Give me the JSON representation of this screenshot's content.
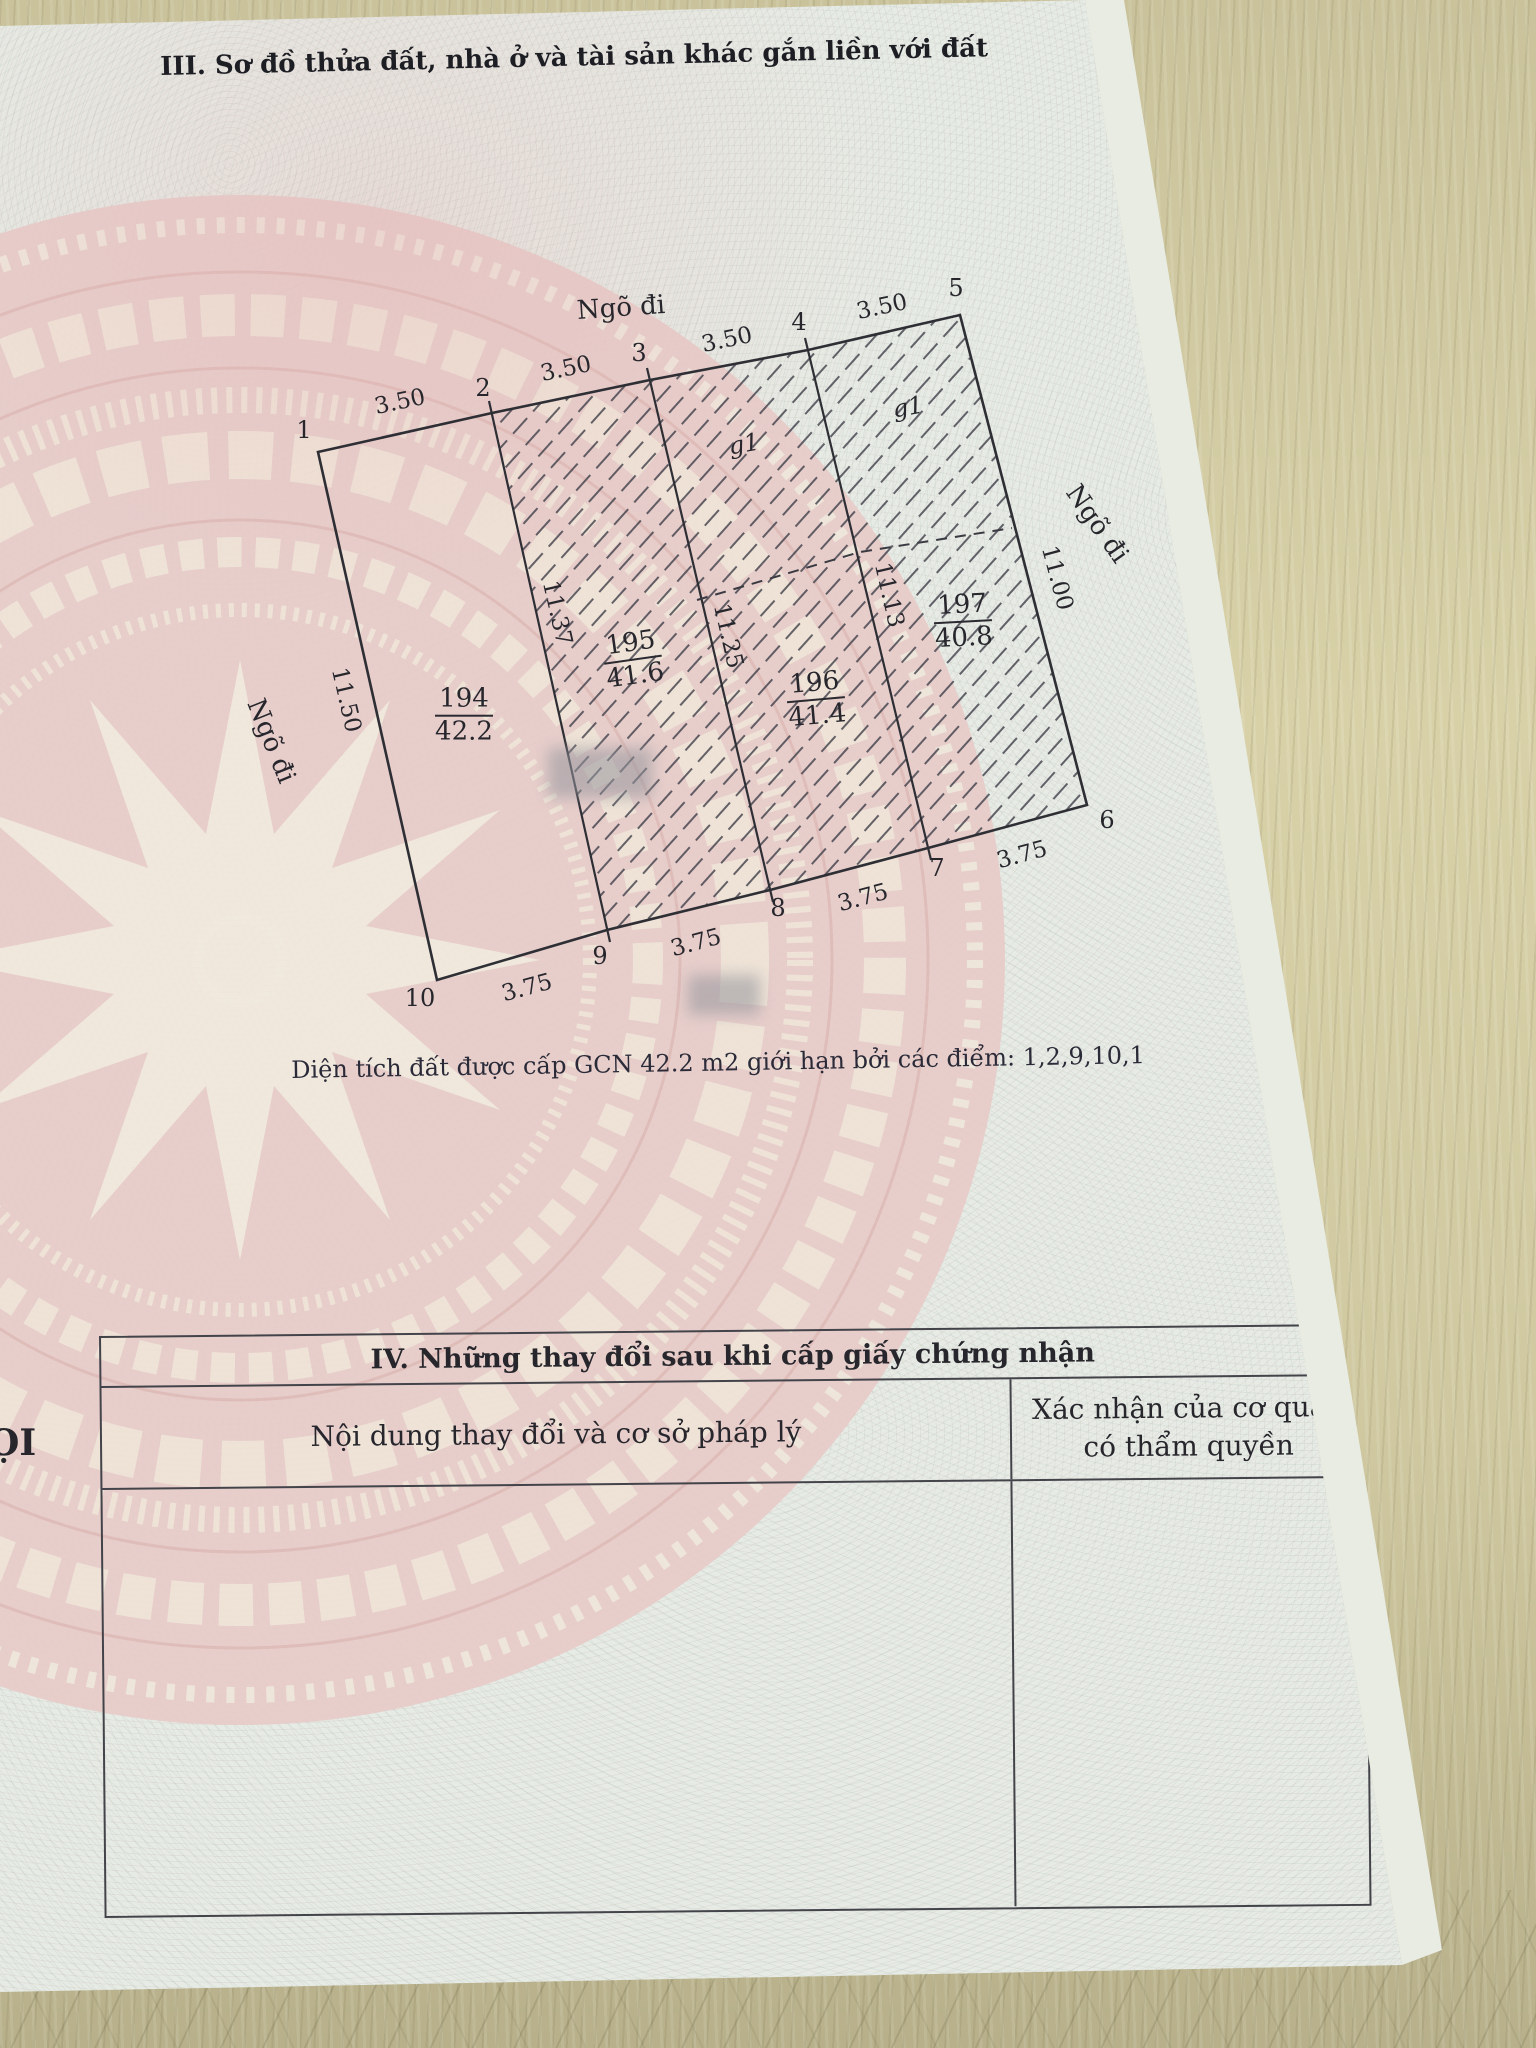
{
  "section3": {
    "title": "III. Sơ đồ thửa đất, nhà ở và tài sản khác gắn liền với đất",
    "area_note": "Diện tích đất được cấp GCN 42.2 m2 giới hạn bởi các điểm: 1,2,9,10,1"
  },
  "compass": {
    "north_label": "B"
  },
  "diagram": {
    "alley_top": "Ngõ đi",
    "alley_left": "Ngõ đi",
    "alley_right": "Ngõ đi",
    "points": [
      "1",
      "2",
      "3",
      "4",
      "5",
      "6",
      "7",
      "8",
      "9",
      "10"
    ],
    "top_dims": [
      "3.50",
      "3.50",
      "3.50",
      "3.50"
    ],
    "bottom_dims": [
      "3.75",
      "3.75",
      "3.75",
      "3.75"
    ],
    "side_dims": {
      "left": "11.50",
      "right": "11.00"
    },
    "interior_dims": [
      "11.37",
      "11.25",
      "11.13"
    ],
    "plots": [
      {
        "number": "194",
        "area": "42.2"
      },
      {
        "number": "195",
        "area": "41.6"
      },
      {
        "number": "196",
        "area": "41.4"
      },
      {
        "number": "197",
        "area": "40.8"
      }
    ],
    "house_labels": [
      "g1",
      "g1"
    ]
  },
  "section4": {
    "title": "IV. Những thay đổi sau khi cấp giấy chứng nhận",
    "col1_header": "Nội dung thay đổi và cơ sở pháp lý",
    "col2_header_line1": "Xác nhận của cơ quan",
    "col2_header_line2": "có thẩm quyền"
  },
  "page_edge_text": "ỌI",
  "colors": {
    "paper_guilloche": "#e7ebe5",
    "drum_pink": "#e8cbc8",
    "drum_cream": "#f1e5d8",
    "wood_background": "#d2cba2",
    "line_ink": "#33333a",
    "text_ink": "#26262c"
  }
}
